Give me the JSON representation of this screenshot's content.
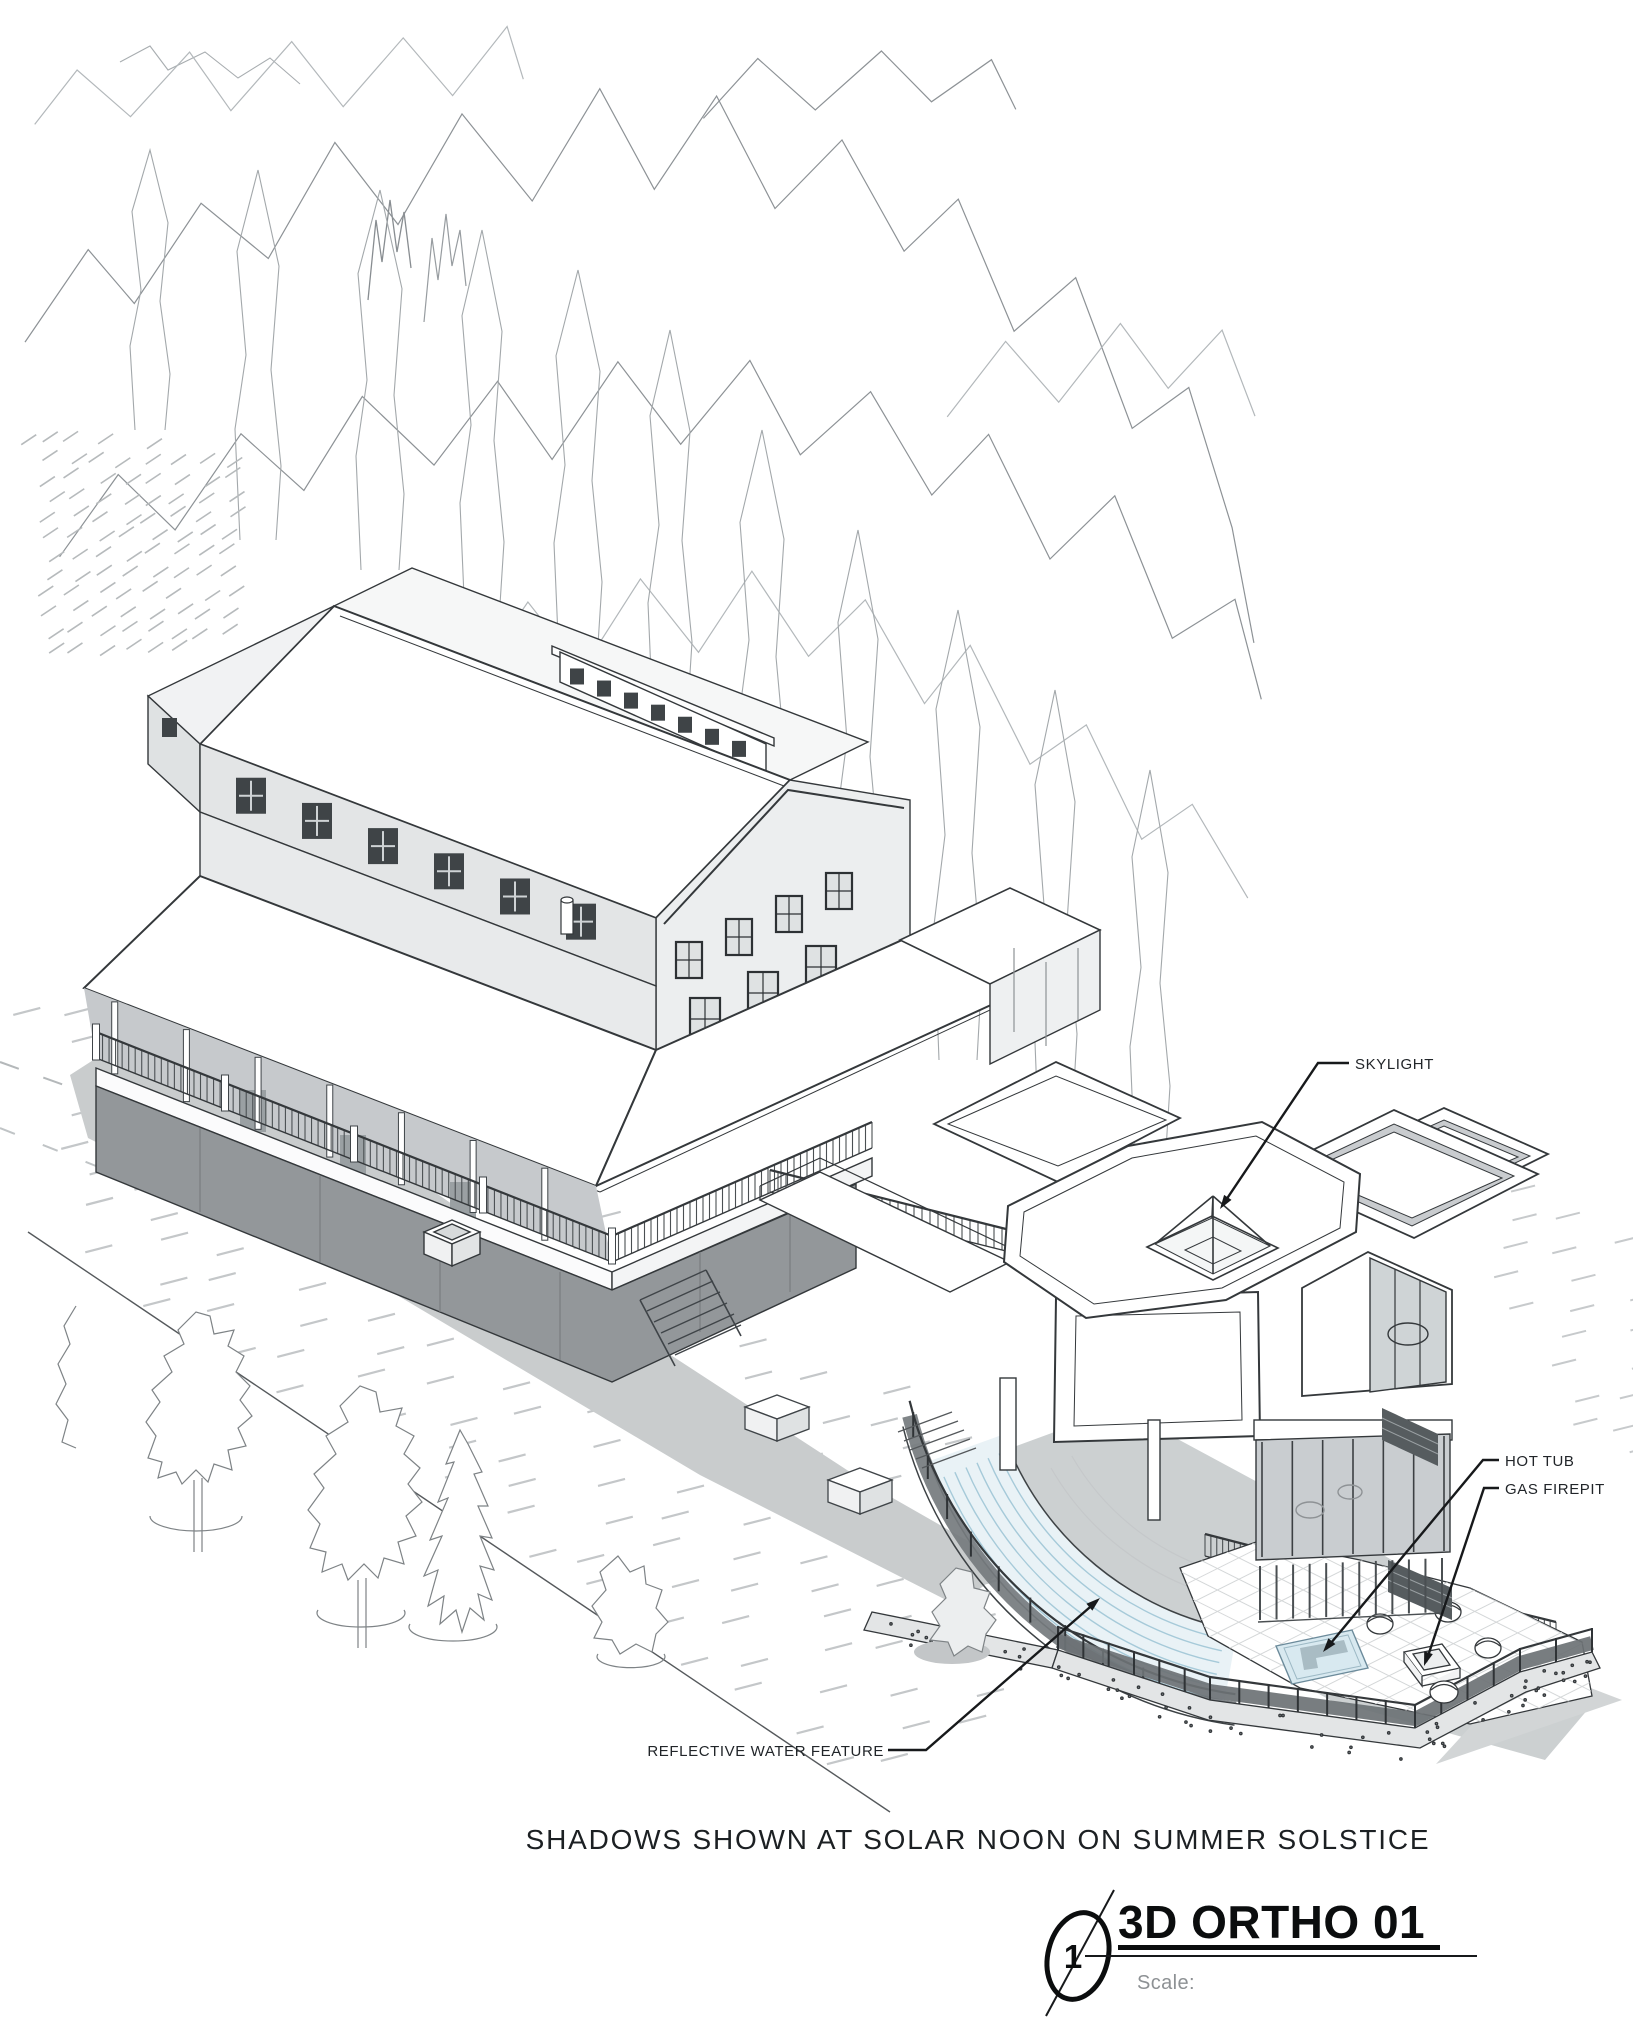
{
  "sheet": {
    "caption": "SHADOWS SHOWN AT SOLAR NOON ON SUMMER SOLSTICE"
  },
  "annotations": {
    "skylight": {
      "label": "SKYLIGHT"
    },
    "hot_tub": {
      "label": "HOT TUB"
    },
    "gas_firepit": {
      "label": "GAS FIREPIT"
    },
    "reflective_water_feature": {
      "label": "REFLECTIVE WATER FEATURE"
    }
  },
  "title_block": {
    "detail_number": "1",
    "view_title": "3D ORTHO 01",
    "scale_label": "Scale:"
  },
  "drawing": {
    "type": "3d-orthographic-architectural-view",
    "features": [
      "forest outline backdrop",
      "gable house with wraparound porch and deck",
      "ridge monitor with clerestory windows",
      "roof vent pipe",
      "modern flat-roof addition",
      "pyramidal skylight",
      "curved reflective water feature",
      "terrace patio with hot tub and gas firepit",
      "mesh guardrails",
      "concrete retaining wall",
      "landscape trees",
      "solar-noon ground shadows"
    ],
    "colors": {
      "paper": "#ffffff",
      "linework": "#303437",
      "tree_outline": "#8f9497",
      "shadow": "#c9cccd",
      "water": "#e9f2f6",
      "glass": "#ccd1d3",
      "deck_skirt": "#93979a"
    }
  }
}
